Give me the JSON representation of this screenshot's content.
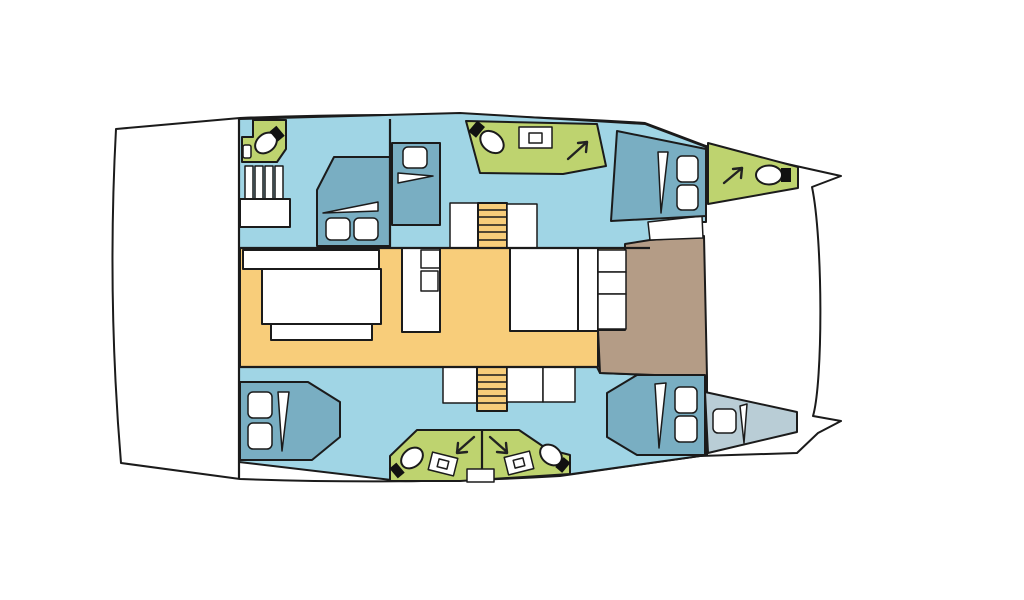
{
  "page": {
    "background": "#ffffff"
  },
  "colors": {
    "outline": "#1b1b1b",
    "hull": "#ffffff",
    "cabin_floor": "#a0d5e5",
    "bed": "#79aec2",
    "bathroom": "#bed36f",
    "saloon_floor": "#f8cd7a",
    "stairs": "#f8cd7a",
    "foredeck": "#b49c86",
    "skipper_berth": "#b9cdd6",
    "furniture": "#ffffff",
    "fixture": "#111111"
  },
  "plan": {
    "type": "boat-floor-plan",
    "subject": "catamaran interior layout, bow at right, stern at left",
    "rooms": [
      {
        "id": "port-aft-head",
        "type": "bathroom"
      },
      {
        "id": "port-companionway",
        "type": "stairs"
      },
      {
        "id": "port-aft-cabin",
        "type": "cabin"
      },
      {
        "id": "port-mid-cabin",
        "type": "cabin"
      },
      {
        "id": "port-mid-head",
        "type": "bathroom"
      },
      {
        "id": "port-forward-cabin",
        "type": "cabin"
      },
      {
        "id": "port-bow-head",
        "type": "bathroom"
      },
      {
        "id": "saloon",
        "type": "saloon"
      },
      {
        "id": "galley",
        "type": "galley"
      },
      {
        "id": "forward-cockpit",
        "type": "deck"
      },
      {
        "id": "starboard-aft-cabin",
        "type": "cabin"
      },
      {
        "id": "starboard-heads",
        "type": "bathroom"
      },
      {
        "id": "starboard-forward-cabin",
        "type": "cabin"
      },
      {
        "id": "skipper-berth",
        "type": "berth"
      }
    ],
    "inventory": {
      "double_beds": 5,
      "single_berths": 1,
      "toilets": 5,
      "sinks": 5,
      "escape_hatch_arrows": 4,
      "staircases": 3
    },
    "icons": {
      "toilet": "toilet-icon",
      "sink": "sink-icon",
      "escape_arrow": "escape-hatch-arrow-icon",
      "pillow": "pillow",
      "blanket_fold": "blanket-fold"
    }
  }
}
